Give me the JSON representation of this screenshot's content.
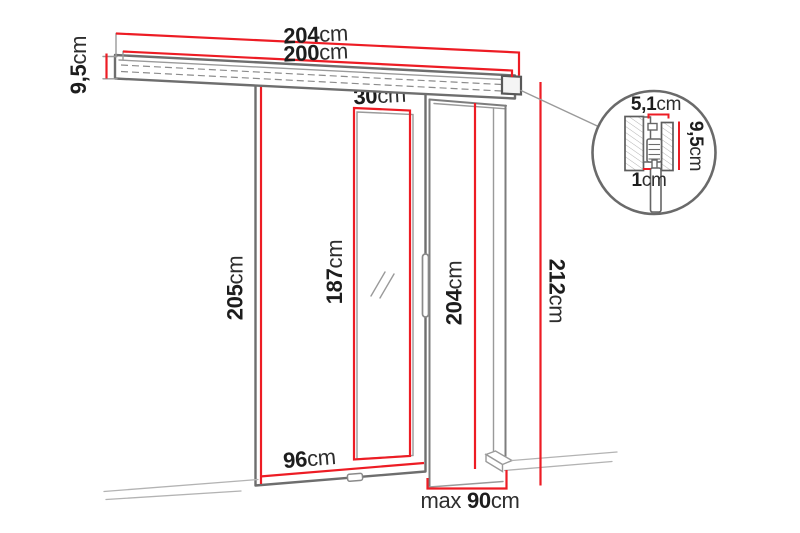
{
  "diagram": {
    "name": "sliding-door-dimension-diagram",
    "colors": {
      "dimension_red": "#ed1c24",
      "outline_gray": "#6e6e6e",
      "text_dark": "#1d1d1d"
    },
    "labels": {
      "rail_outer_width": {
        "value": "204",
        "unit": "cm"
      },
      "rail_inner_width": {
        "value": "200",
        "unit": "cm"
      },
      "rail_height": {
        "value": "9,5",
        "unit": "cm"
      },
      "door_height": {
        "value": "205",
        "unit": "cm"
      },
      "door_width": {
        "value": "96",
        "unit": "cm"
      },
      "mirror_width": {
        "value": "30",
        "unit": "cm"
      },
      "mirror_height": {
        "value": "187",
        "unit": "cm"
      },
      "opening_height": {
        "value": "204",
        "unit": "cm"
      },
      "total_height": {
        "value": "212",
        "unit": "cm"
      },
      "opening_width": {
        "prefix": "max ",
        "value": "90",
        "unit": "cm"
      },
      "detail_track_width": {
        "value": "5,1",
        "unit": "cm"
      },
      "detail_track_height": {
        "value": "9,5",
        "unit": "cm"
      },
      "detail_gap": {
        "value": "1",
        "unit": "cm"
      }
    }
  }
}
